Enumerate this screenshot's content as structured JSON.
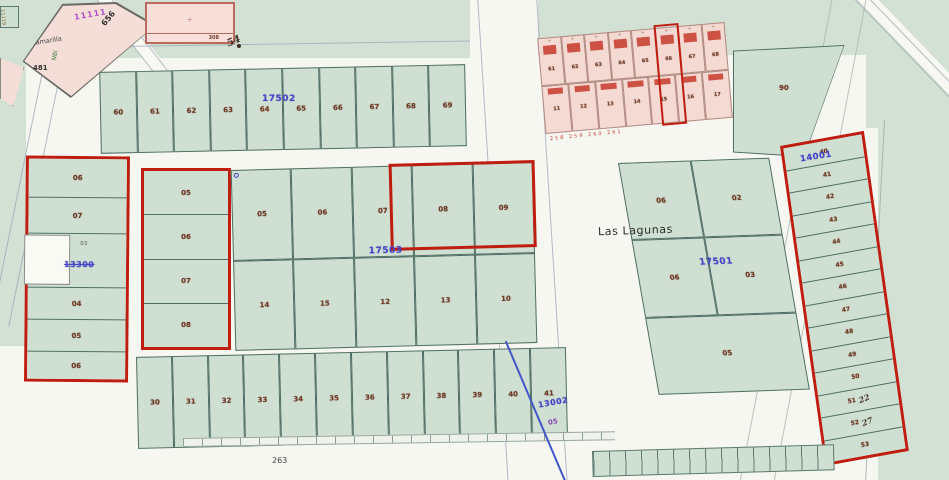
{
  "labels": {
    "place": "Las Lagunas",
    "road_656": "656",
    "road_481": "481",
    "road_nbi": "NBI",
    "bottom_ref": "263",
    "corner_code": "11119"
  },
  "camarilla": {
    "code": "11111",
    "name": "Camarilla"
  },
  "building_block": {
    "code": "308",
    "hand_note": "54",
    "mark": "+"
  },
  "top_row": {
    "blue_code": "17502",
    "parcels": [
      "60",
      "61",
      "62",
      "63",
      "64",
      "65",
      "66",
      "67",
      "68",
      "69"
    ]
  },
  "pink_cluster": {
    "cell_mark": "+",
    "row1": [
      "61",
      "62",
      "63",
      "64",
      "65",
      "66",
      "67",
      "68"
    ],
    "row2": [
      "11",
      "12",
      "13",
      "14",
      "15",
      "16",
      "17"
    ],
    "red_labels": "258 259 260 261"
  },
  "big_parcel": {
    "num": "90"
  },
  "left_block": {
    "rows": [
      "06",
      "07",
      "",
      "04",
      "05",
      "06"
    ],
    "small_code": "03",
    "blue_code": "13300"
  },
  "center_left": {
    "rows": [
      "05",
      "06",
      "07",
      "08"
    ]
  },
  "center_block": {
    "blue_code": "17503",
    "top": [
      "05",
      "06",
      "07",
      "08",
      "09"
    ],
    "bottom": [
      "14",
      "15",
      "12",
      "13",
      "10"
    ]
  },
  "lagunas_block": {
    "blue_code": "17501",
    "cells": [
      "06",
      "02",
      "06",
      "03",
      "05"
    ]
  },
  "bottom_row": {
    "parcels": [
      "30",
      "31",
      "32",
      "33",
      "34",
      "35",
      "36",
      "37",
      "38",
      "39",
      "40",
      "41"
    ]
  },
  "stream": {
    "blue_code": "13002",
    "purple_code": "05"
  },
  "right_column": {
    "blue_code": "14001",
    "rows": [
      {
        "n": "40",
        "h": ""
      },
      {
        "n": "41",
        "h": ""
      },
      {
        "n": "42",
        "h": ""
      },
      {
        "n": "43",
        "h": ""
      },
      {
        "n": "44",
        "h": ""
      },
      {
        "n": "45",
        "h": ""
      },
      {
        "n": "46",
        "h": ""
      },
      {
        "n": "47",
        "h": ""
      },
      {
        "n": "48",
        "h": ""
      },
      {
        "n": "49",
        "h": ""
      },
      {
        "n": "50",
        "h": ""
      },
      {
        "n": "51",
        "h": "22"
      },
      {
        "n": "52",
        "h": "27"
      },
      {
        "n": "53",
        "h": ""
      }
    ]
  },
  "colors": {
    "selection_red": "#bf1d10",
    "polygon_blue": "#4444c6",
    "parcel_green": "#cfdfd2",
    "urban_pink": "#f4dad2"
  }
}
